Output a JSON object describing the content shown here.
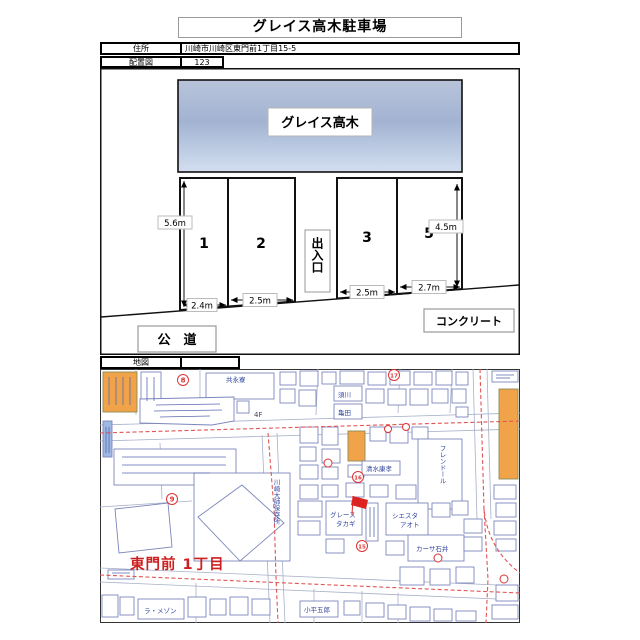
{
  "title": "グレイス高木駐車場",
  "header": {
    "address_label": "住所",
    "address_value": "川崎市川崎区東門前1丁目15-5",
    "layout_label": "配置図",
    "layout_no": "123",
    "map_label": "地図"
  },
  "diagram": {
    "building_name": "グレイス高木",
    "entrance": "出入口",
    "public_road": "公　道",
    "concrete": "コンクリート",
    "depth_left": "5.6m",
    "depth_right": "4.5m",
    "spaces": [
      {
        "number": "1",
        "width": "2.4m"
      },
      {
        "number": "2",
        "width": "2.5m"
      },
      {
        "number": "3",
        "width": "2.5m"
      },
      {
        "number": "5",
        "width": "2.7m"
      }
    ]
  },
  "map": {
    "district": "東門前 1丁目",
    "labels": {
      "kyoeiryo": "共永寮",
      "sugawa": "須川",
      "kameda": "亀田",
      "floor4": "4F",
      "daishi": "川崎大師保存所",
      "grace1": "グレース",
      "grace2": "タカギ",
      "siesta1": "シエスタ",
      "siesta2": "アオト",
      "casa": "カーサ石井",
      "friendl": "フレンドール",
      "shimizu": "清水康孝",
      "lamaison": "ラ・メゾン",
      "kodaira": "小平五郎"
    },
    "markers": {
      "m8": "8",
      "m9": "9",
      "m15": "15",
      "m16": "16",
      "m17": "17"
    },
    "colors": {
      "highlight_orange": "#f0a348",
      "route_red": "#e05555",
      "building_outline": "#7c86bb",
      "map_text_blue": "#3347a0",
      "district_red": "#cc2020"
    }
  }
}
